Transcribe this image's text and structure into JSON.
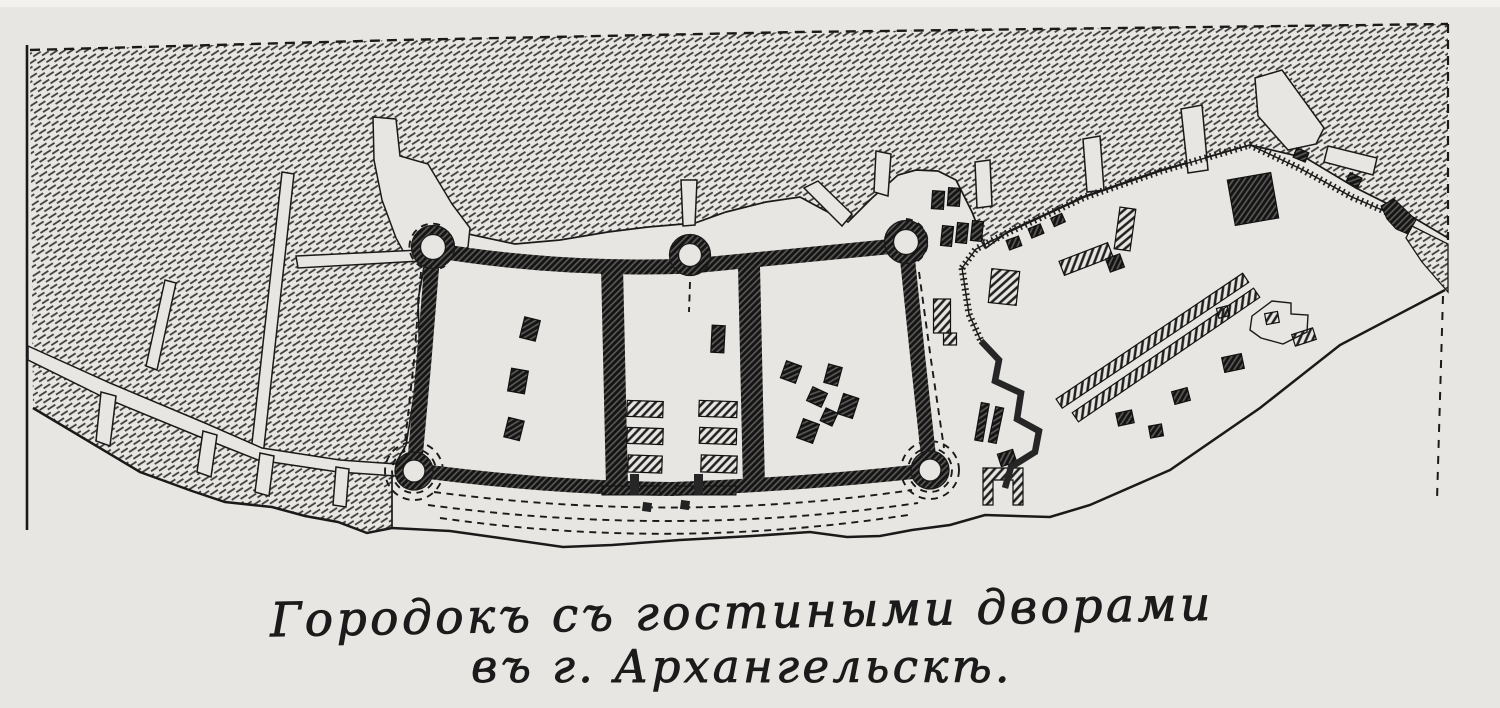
{
  "figure": {
    "kind": "engraved-plan-scan",
    "caption": {
      "line1": "Городокъ съ гостиными дворами",
      "line2": "въ г. Архангельскѣ."
    },
    "palette": {
      "paper": "#e7e6e2",
      "paper_light": "#f2f1ee",
      "ink": "#1a1a1a",
      "hatch": "#3a3a3a",
      "wall_dark": "#575757"
    }
  }
}
